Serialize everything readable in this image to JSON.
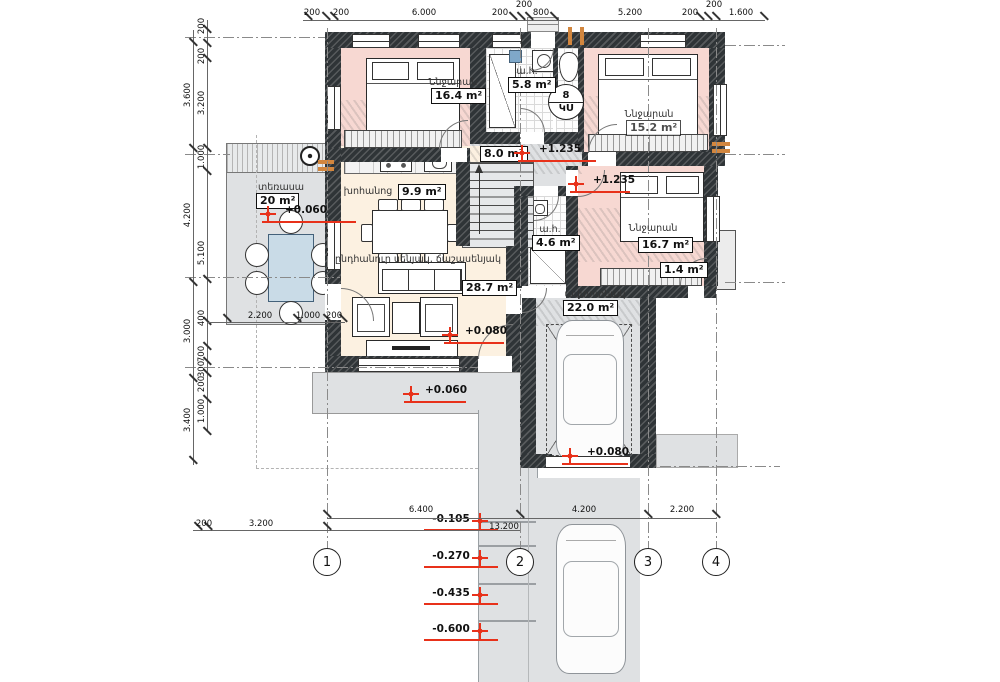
{
  "rooms": {
    "bedroom1": {
      "name": "Ննջարան",
      "area": "16.4 m²"
    },
    "bath1": {
      "name": "ա.հ.",
      "area": "5.8 m²"
    },
    "bedroom2": {
      "name": "Ննջարան",
      "area": "15.2 m²"
    },
    "hall": {
      "area": "8.0 m²"
    },
    "terrace": {
      "name": "տեռասա",
      "area": "20 m²"
    },
    "kitchen": {
      "name": "խոհանոց",
      "area": "9.9 m²"
    },
    "bath2": {
      "name": "ա.հ.",
      "area": "4.6 m²"
    },
    "bedroom3": {
      "name": "Ննջարան",
      "area": "16.7 m²"
    },
    "balcony": {
      "area": "1.4 m²"
    },
    "living": {
      "name": "ընդհանուր սենյակ, ճաշասենյակ",
      "area": "28.7 m²"
    },
    "garage": {
      "name": "ավտոտնակ",
      "area": "22.0 m²"
    }
  },
  "elevations": {
    "hall": "+1.235",
    "bedroom3": "+1.235",
    "terrace": "+0.060",
    "living": "+0.080",
    "porch": "+0.060",
    "garage": "+0.080",
    "step1": "-0.105",
    "step2": "-0.270",
    "step3": "-0.435",
    "step4": "-0.600"
  },
  "dims": {
    "top": [
      "200",
      "200",
      "6.000",
      "200",
      "800",
      "5.200",
      "200",
      "1.600"
    ],
    "top_upper": [
      "200",
      "200"
    ],
    "left_outer": [
      "3.600",
      "4.200",
      "3.000",
      "3.400"
    ],
    "left_inner": [
      "200",
      "200",
      "3.200",
      "1.000",
      "5.100",
      "400",
      "700",
      "300",
      "200",
      "1.000"
    ],
    "terrace": [
      "2.200",
      "1.000",
      "200"
    ],
    "bottom_upper": [
      "6.400",
      "4.200",
      "2.200"
    ],
    "bottom_lower": [
      "200",
      "3.200",
      "13.200"
    ]
  },
  "axes": [
    "1",
    "2",
    "3",
    "4"
  ],
  "room_tag": {
    "number": "8",
    "code": "ԿՍ"
  },
  "colors": {
    "bedroom_fill": "#f7d8d2",
    "living_fill": "#fcf1e1",
    "zone_fill": "#dfe1e3",
    "wall": "#2f3437",
    "elevation_red": "#e8311a",
    "accent_orange": "#d2863e",
    "table_blue": "#c9dbe7"
  }
}
